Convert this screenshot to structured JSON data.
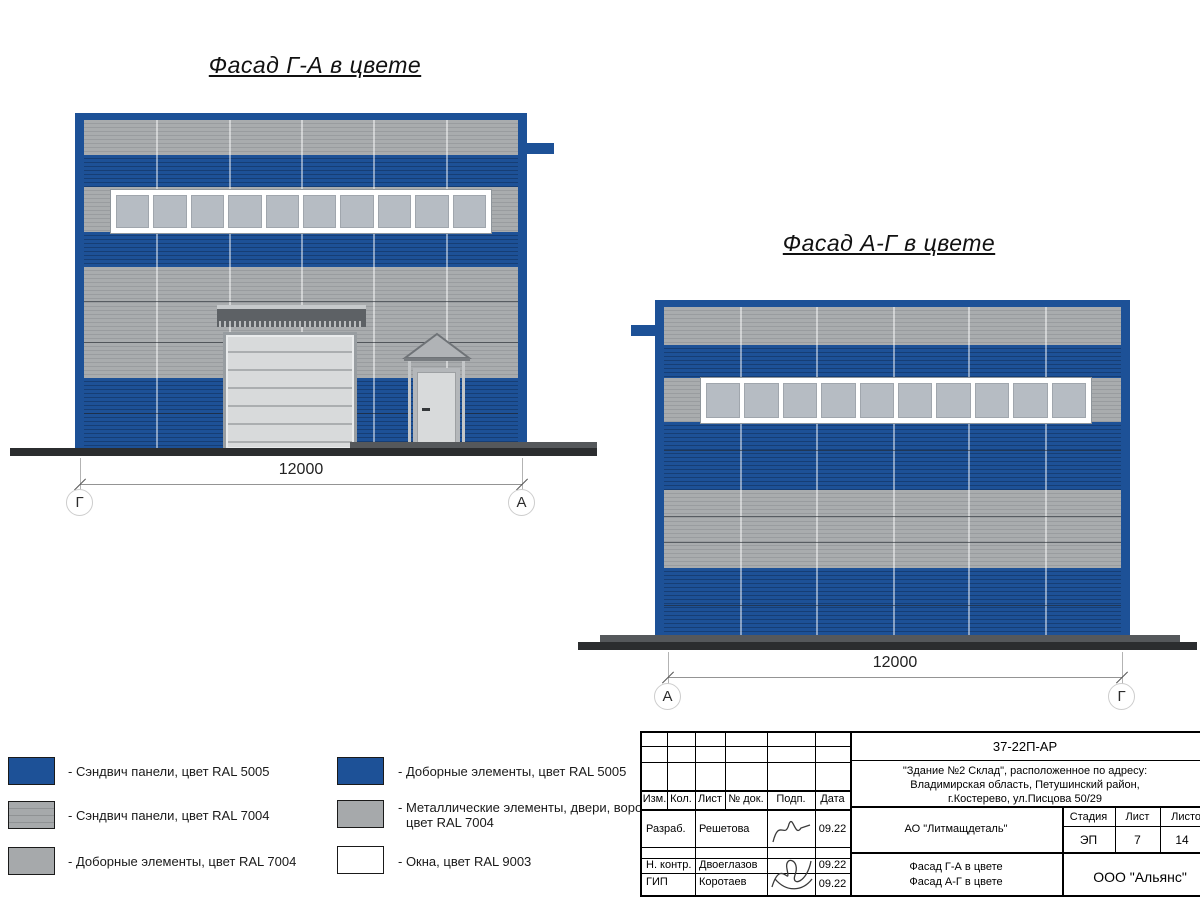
{
  "titles": {
    "facade_left": "Фасад Г-А в цвете",
    "facade_right": "Фасад А-Г в цвете"
  },
  "dimensions": {
    "left_value": "12000",
    "right_value": "12000",
    "left_axis_start": "Г",
    "left_axis_end": "А",
    "right_axis_start": "А",
    "right_axis_end": "Г"
  },
  "legend": {
    "col1": [
      {
        "label": "- Сэндвич панели, цвет RAL 5005"
      },
      {
        "label": "- Сэндвич панели, цвет RAL 7004"
      },
      {
        "label": "- Доборные элементы, цвет RAL 7004"
      }
    ],
    "col2": [
      {
        "label": "- Доборные элементы, цвет RAL 5005"
      },
      {
        "label_line1": "- Металлические элементы, двери, ворота,",
        "label_line2": "цвет RAL 7004"
      },
      {
        "label": "- Окна, цвет RAL 9003"
      }
    ]
  },
  "title_block": {
    "code": "37-22П-АР",
    "address_line1": "\"Здание №2 Склад\", расположенное по адресу:",
    "address_line2": "Владимирская область, Петушинский район,",
    "address_line3": "г.Костерево, ул.Писцова 50/29",
    "header_cells": [
      "Изм.",
      "Кол.",
      "Лист",
      "№ док.",
      "Подп.",
      "Дата"
    ],
    "rows": [
      {
        "role": "Разраб.",
        "name": "Решетова",
        "date": "09.22"
      },
      {
        "role": "Н. контр.",
        "name": "Двоеглазов",
        "date": "09.22"
      },
      {
        "role": "ГИП",
        "name": "Коротаев",
        "date": "09.22"
      }
    ],
    "organization": "АО \"Литмащдеталь\"",
    "stage_label": "Стадия",
    "sheet_label": "Лист",
    "sheets_label": "Листов",
    "stage_value": "ЭП",
    "sheet_value": "7",
    "sheets_value": "14",
    "doc_title_line1": "Фасад Г-А в цвете",
    "doc_title_line2": "Фасад А-Г в цвете",
    "company": "ООО \"Альянс\""
  },
  "colors": {
    "ral5005_blue": "#1d5197",
    "ral7004_gray": "#a6a9ab",
    "ral9003_white": "#ffffff",
    "window_pane": "#b6bcc3",
    "ground": "#2b2d2f"
  }
}
